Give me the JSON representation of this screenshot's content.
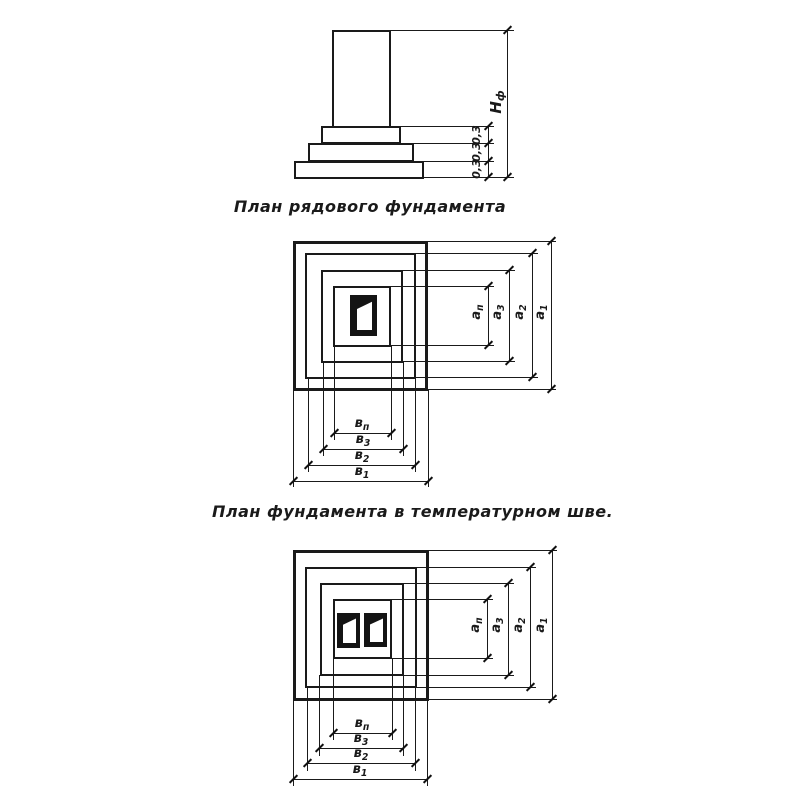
{
  "elevation": {
    "height_label": {
      "main": "Н",
      "sub": "ф"
    },
    "step_labels": [
      "0,3",
      "0,3",
      "0,3"
    ]
  },
  "plan_single": {
    "caption": "План рядового фундамента",
    "width_labels": [
      {
        "main": "а",
        "sub": "п"
      },
      {
        "main": "а",
        "sub": "3"
      },
      {
        "main": "а",
        "sub": "2"
      },
      {
        "main": "а",
        "sub": "1"
      }
    ],
    "depth_labels": [
      {
        "main": "в",
        "sub": "п"
      },
      {
        "main": "в",
        "sub": "3"
      },
      {
        "main": "в",
        "sub": "2"
      },
      {
        "main": "в",
        "sub": "1"
      }
    ]
  },
  "plan_joint": {
    "caption": "План фундамента в температурном шве.",
    "width_labels": [
      {
        "main": "а",
        "sub": "п"
      },
      {
        "main": "а",
        "sub": "3"
      },
      {
        "main": "а",
        "sub": "2"
      },
      {
        "main": "а",
        "sub": "1"
      }
    ],
    "depth_labels": [
      {
        "main": "в",
        "sub": "п"
      },
      {
        "main": "в",
        "sub": "3"
      },
      {
        "main": "в",
        "sub": "2"
      },
      {
        "main": "в",
        "sub": "1"
      }
    ]
  }
}
